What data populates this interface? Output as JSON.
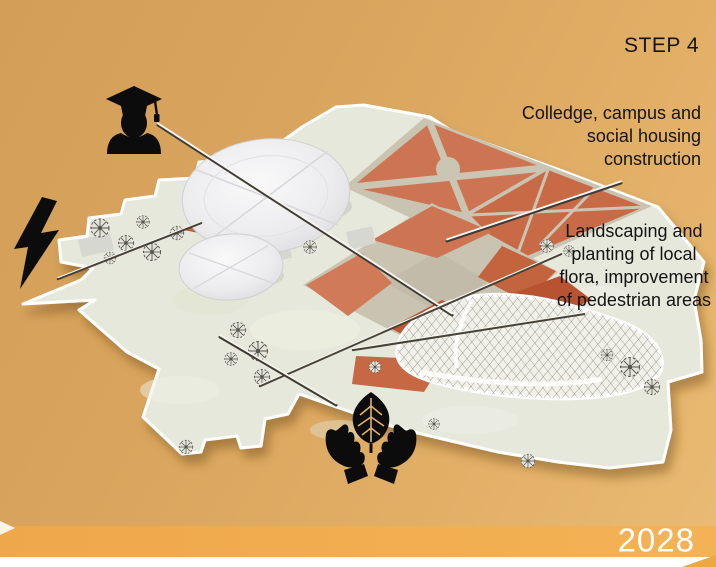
{
  "slide": {
    "step_label": "STEP 4",
    "year": "2028"
  },
  "annotations": {
    "college": "Colledge, campus and\nsocial housing\nconstruction",
    "landscaping": "Landscaping and\nplanting of local\nflora, improvement\nof pedestrian areas"
  },
  "icons": {
    "graduate": "graduate-student",
    "lightning": "electric-power",
    "hands_leaf": "hands-holding-leaf"
  },
  "colors": {
    "bg_top": "#d29e58",
    "bg_bottom": "#eabb74",
    "ribbon": "#f2ad4d",
    "strip": "#ffffff",
    "terrain": "#e7e8dc",
    "path_grey": "#c9c3b1",
    "plaza_orange": "#cd7452",
    "plaza_orange_dark": "#bc5633",
    "dome_white": "#efeff1",
    "ink": "#141414",
    "year_text": "#ffffff"
  }
}
